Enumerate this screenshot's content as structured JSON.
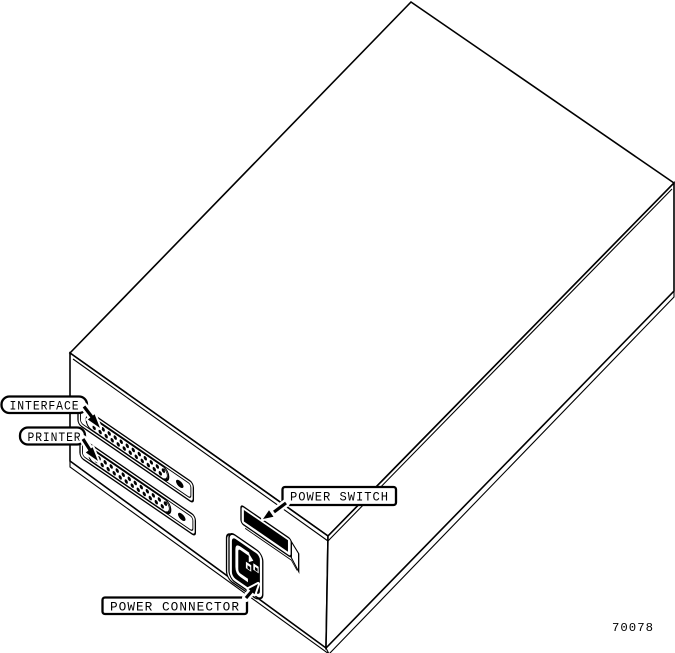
{
  "figure": {
    "number": "70078"
  },
  "callouts": {
    "interface": "INTERFACE",
    "printer": "PRINTER",
    "power_switch": "POWER SWITCH",
    "power_connector": "POWER CONNECTOR"
  },
  "parts": {
    "enclosure": "equipment-enclosure-rear-isometric",
    "interface_connector": "db25-connector",
    "printer_connector": "db25-connector",
    "power_switch": "rocker-switch",
    "power_connector": "iec-power-inlet"
  },
  "colors": {
    "line": "#000000",
    "background": "#ffffff"
  }
}
